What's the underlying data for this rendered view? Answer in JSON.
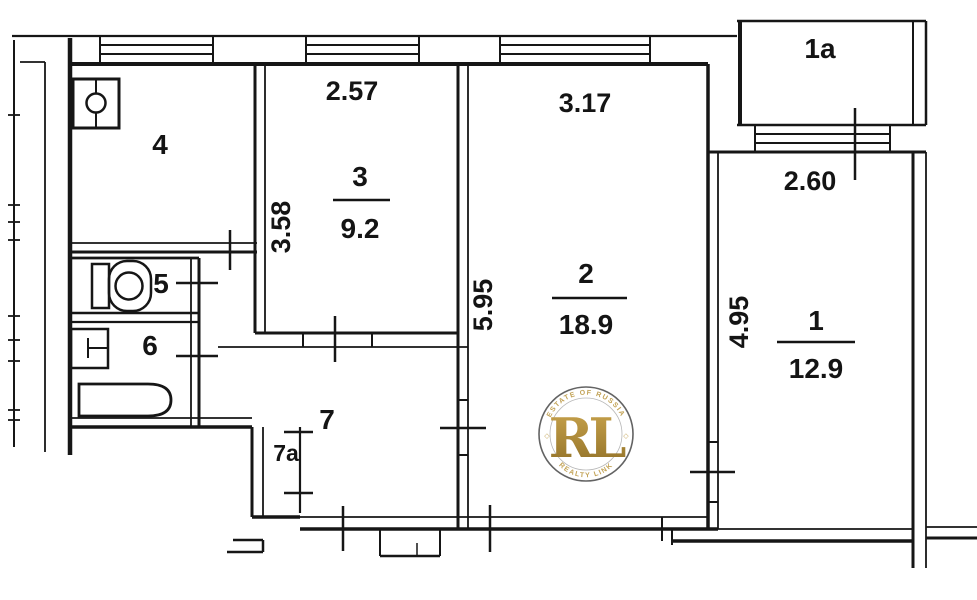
{
  "plan": {
    "title": "apartment-floor-plan",
    "rooms": {
      "r1": {
        "label": "1",
        "area": "12.9",
        "dim_horizontal": "2.60",
        "dim_vertical": "4.95"
      },
      "r1a": {
        "label": "1a"
      },
      "r2": {
        "label": "2",
        "area": "18.9",
        "dim_horizontal": "3.17",
        "dim_vertical": "5.95"
      },
      "r3": {
        "label": "3",
        "area": "9.2",
        "dim_horizontal": "2.57",
        "dim_vertical": "3.58"
      },
      "r4": {
        "label": "4"
      },
      "r5": {
        "label": "5"
      },
      "r6": {
        "label": "6"
      },
      "r7": {
        "label": "7"
      },
      "r7a": {
        "label": "7a"
      }
    },
    "fixtures": [
      "kitchen-sink-icon",
      "toilet-icon",
      "washbasin-icon",
      "bathtub-icon"
    ],
    "colors": {
      "line": "#161616",
      "watermark_gold": "#b08d3c",
      "watermark_gold_light": "#d9b863"
    }
  },
  "watermark": {
    "initials": "RL",
    "arc_top": "ESTATE OF RUSSIA",
    "arc_bottom": "REALTY LINK",
    "side_mark": "◇"
  }
}
